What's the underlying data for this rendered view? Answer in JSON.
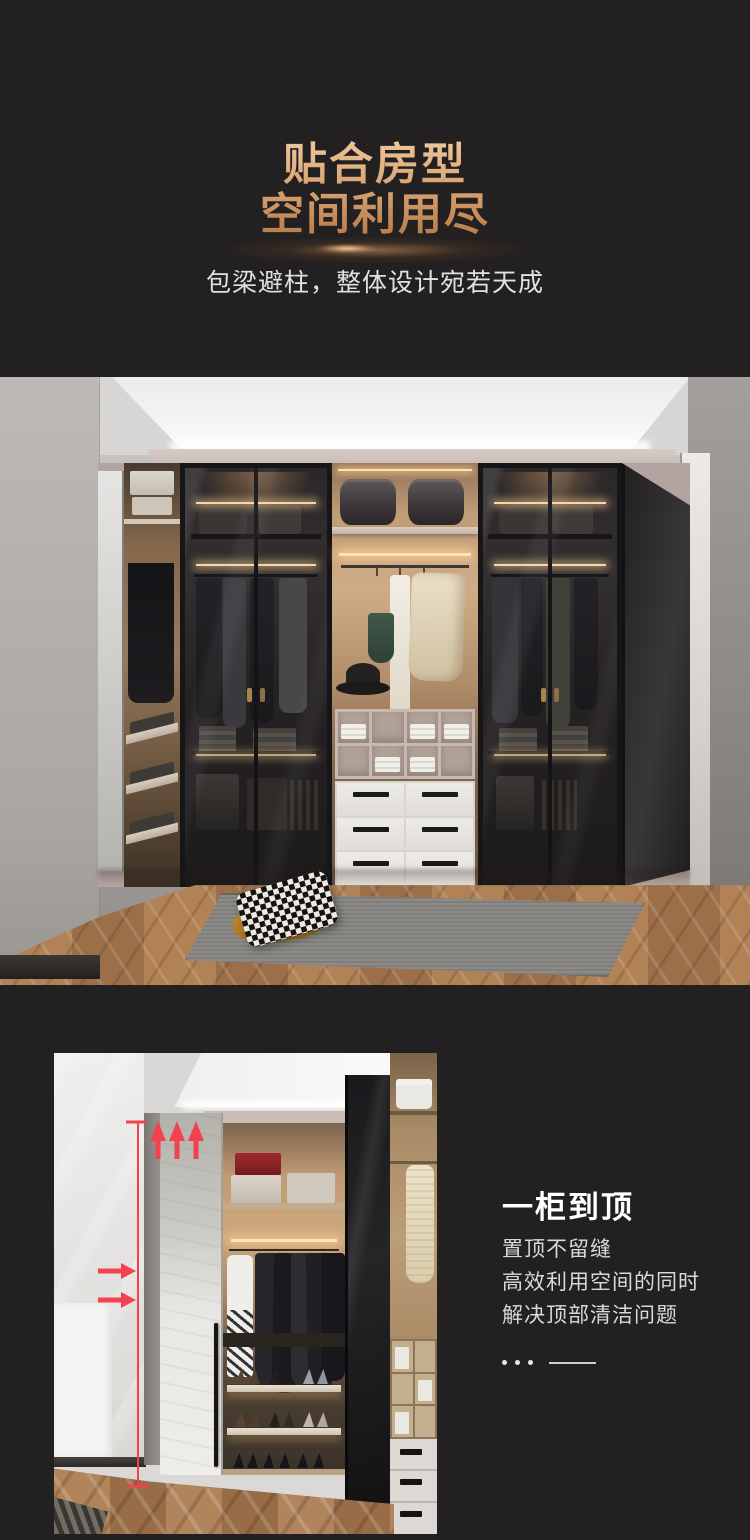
{
  "page": {
    "background_color": "#232021"
  },
  "hero": {
    "title_line1": "贴合房型",
    "title_line2": "空间利用尽",
    "subtitle": "包梁避柱，整体设计宛若天成",
    "title_gradient_top": "#eec79b",
    "title_gradient_bottom": "#b57a48",
    "subtitle_color": "#e3e1e0"
  },
  "feature": {
    "title": "一柜到顶",
    "lines": [
      "置顶不留缝",
      "高效利用空间的同时",
      "解决顶部清洁问题"
    ],
    "title_color": "#ffffff",
    "text_color": "#dad9d8",
    "annotation_color": "#f2414f"
  }
}
